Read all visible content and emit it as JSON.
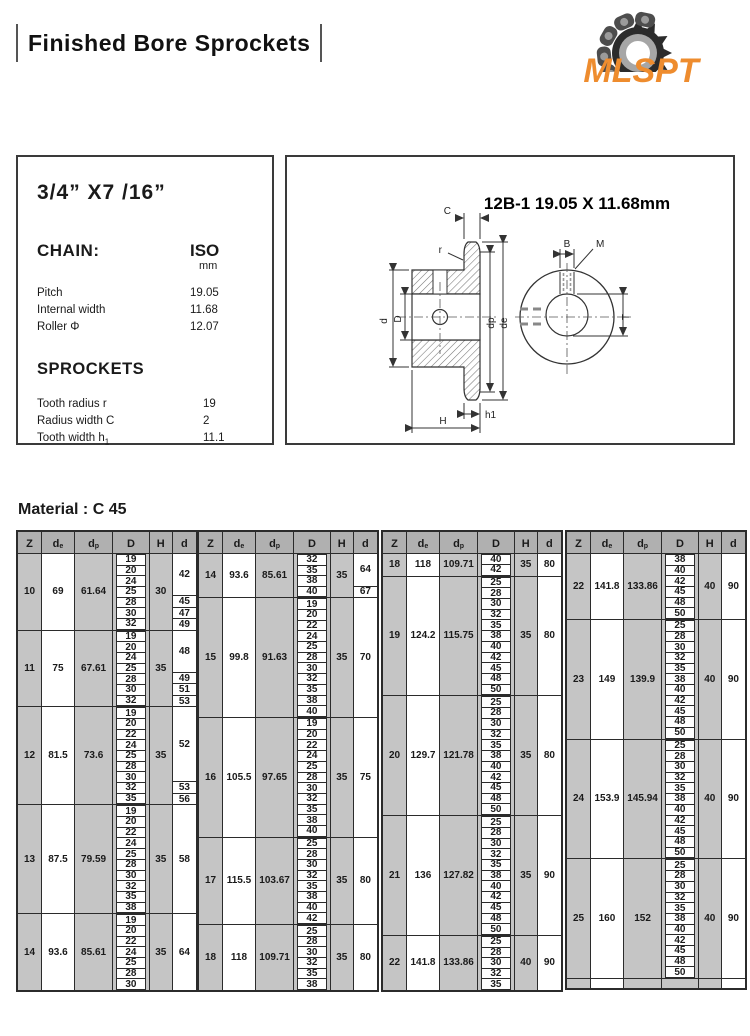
{
  "header": {
    "title": "Finished Bore Sprockets",
    "logo_text": "MLSPT",
    "logo_color": "#ee8c2e"
  },
  "spec_box": {
    "size_title": "3/4” X7 /16”",
    "chain_label": "CHAIN:",
    "standard_label": "ISO",
    "standard_unit": "mm",
    "chain_rows": [
      {
        "label": "Pitch",
        "value": "19.05"
      },
      {
        "label": "Internal width",
        "value": "11.68"
      },
      {
        "label": "Roller  Φ",
        "value": "12.07"
      }
    ],
    "sprockets_label": "SPROCKETS",
    "sprocket_rows": [
      {
        "label": "Tooth radius  r",
        "value": "19"
      },
      {
        "label": "Radius width C",
        "value": "2"
      },
      {
        "label": "Tooth width h",
        "label_sub": "1",
        "value": "11.1"
      }
    ]
  },
  "drawing": {
    "title": "12B-1 19.05 X 11.68mm",
    "labels": {
      "c": "C",
      "r": "r",
      "d_small": "d",
      "d_cap": "D",
      "dp": "dp",
      "de": "de",
      "h1": "h1",
      "h_cap": "H",
      "b": "B",
      "m": "M",
      "t": "T"
    }
  },
  "material_label": "Material : C 45",
  "table": {
    "columns": [
      {
        "label": "Z"
      },
      {
        "label": "d",
        "sub": "e"
      },
      {
        "label": "d",
        "sub": "p"
      },
      {
        "label": "D"
      },
      {
        "label": "H"
      },
      {
        "label": "d"
      }
    ]
  },
  "tables": [
    {
      "groups": [
        {
          "z": "10",
          "de": "69",
          "dp": "61.64",
          "h": "30",
          "bores": [
            "19",
            "20",
            "24",
            "25",
            "28",
            "30",
            "32"
          ],
          "d_segments": [
            {
              "value": "42",
              "span": 4
            },
            {
              "value": "45",
              "span": 1
            },
            {
              "value": "47",
              "span": 1
            },
            {
              "value": "49",
              "span": 1
            }
          ]
        },
        {
          "z": "11",
          "de": "75",
          "dp": "67.61",
          "h": "35",
          "bores": [
            "19",
            "20",
            "24",
            "25",
            "28",
            "30",
            "32"
          ],
          "d_segments": [
            {
              "value": "48",
              "span": 4
            },
            {
              "value": "49",
              "span": 1
            },
            {
              "value": "51",
              "span": 1
            },
            {
              "value": "53",
              "span": 1
            }
          ]
        },
        {
          "z": "12",
          "de": "81.5",
          "dp": "73.6",
          "h": "35",
          "bores": [
            "19",
            "20",
            "22",
            "24",
            "25",
            "28",
            "30",
            "32",
            "35"
          ],
          "d_segments": [
            {
              "value": "52",
              "span": 7
            },
            {
              "value": "53",
              "span": 1
            },
            {
              "value": "56",
              "span": 1
            }
          ]
        },
        {
          "z": "13",
          "de": "87.5",
          "dp": "79.59",
          "h": "35",
          "bores": [
            "19",
            "20",
            "22",
            "24",
            "25",
            "28",
            "30",
            "32",
            "35",
            "38"
          ],
          "d_segments": [
            {
              "value": "58",
              "span": 10
            }
          ]
        },
        {
          "z": "14",
          "de": "93.6",
          "dp": "85.61",
          "h": "35",
          "bores": [
            "19",
            "20",
            "22",
            "24",
            "25",
            "28",
            "30"
          ],
          "d_segments": [
            {
              "value": "64",
              "span": 7
            }
          ]
        }
      ]
    },
    {
      "groups": [
        {
          "z": "14",
          "de": "93.6",
          "dp": "85.61",
          "h": "35",
          "bores": [
            "32",
            "35",
            "38",
            "40"
          ],
          "d_segments": [
            {
              "value": "64",
              "span": 3
            },
            {
              "value": "67",
              "span": 1
            }
          ]
        },
        {
          "z": "15",
          "de": "99.8",
          "dp": "91.63",
          "h": "35",
          "bores": [
            "19",
            "20",
            "22",
            "24",
            "25",
            "28",
            "30",
            "32",
            "35",
            "38",
            "40"
          ],
          "d_segments": [
            {
              "value": "70",
              "span": 11
            }
          ]
        },
        {
          "z": "16",
          "de": "105.5",
          "dp": "97.65",
          "h": "35",
          "bores": [
            "19",
            "20",
            "22",
            "24",
            "25",
            "28",
            "30",
            "32",
            "35",
            "38",
            "40"
          ],
          "d_segments": [
            {
              "value": "75",
              "span": 11
            }
          ]
        },
        {
          "z": "17",
          "de": "115.5",
          "dp": "103.67",
          "h": "35",
          "bores": [
            "25",
            "28",
            "30",
            "32",
            "35",
            "38",
            "40",
            "42"
          ],
          "d_segments": [
            {
              "value": "80",
              "span": 8
            }
          ]
        },
        {
          "z": "18",
          "de": "118",
          "dp": "109.71",
          "h": "35",
          "bores": [
            "25",
            "28",
            "30",
            "32",
            "35",
            "38"
          ],
          "d_segments": [
            {
              "value": "80",
              "span": 6
            }
          ]
        }
      ]
    },
    {
      "groups": [
        {
          "z": "18",
          "de": "118",
          "dp": "109.71",
          "h": "35",
          "bores": [
            "40",
            "42"
          ],
          "d_segments": [
            {
              "value": "80",
              "span": 2
            }
          ]
        },
        {
          "z": "19",
          "de": "124.2",
          "dp": "115.75",
          "h": "35",
          "bores": [
            "25",
            "28",
            "30",
            "32",
            "35",
            "38",
            "40",
            "42",
            "45",
            "48",
            "50"
          ],
          "d_segments": [
            {
              "value": "80",
              "span": 11
            }
          ]
        },
        {
          "z": "20",
          "de": "129.7",
          "dp": "121.78",
          "h": "35",
          "bores": [
            "25",
            "28",
            "30",
            "32",
            "35",
            "38",
            "40",
            "42",
            "45",
            "48",
            "50"
          ],
          "d_segments": [
            {
              "value": "80",
              "span": 11
            }
          ]
        },
        {
          "z": "21",
          "de": "136",
          "dp": "127.82",
          "h": "35",
          "bores": [
            "25",
            "28",
            "30",
            "32",
            "35",
            "38",
            "40",
            "42",
            "45",
            "48",
            "50"
          ],
          "d_segments": [
            {
              "value": "90",
              "span": 11
            }
          ]
        },
        {
          "z": "22",
          "de": "141.8",
          "dp": "133.86",
          "h": "40",
          "bores": [
            "25",
            "28",
            "30",
            "32",
            "35"
          ],
          "d_segments": [
            {
              "value": "90",
              "span": 5
            }
          ]
        }
      ]
    },
    {
      "empty_footer": true,
      "groups": [
        {
          "z": "22",
          "de": "141.8",
          "dp": "133.86",
          "h": "40",
          "bores": [
            "38",
            "40",
            "42",
            "45",
            "48",
            "50"
          ],
          "d_segments": [
            {
              "value": "90",
              "span": 6
            }
          ]
        },
        {
          "z": "23",
          "de": "149",
          "dp": "139.9",
          "h": "40",
          "bores": [
            "25",
            "28",
            "30",
            "32",
            "35",
            "38",
            "40",
            "42",
            "45",
            "48",
            "50"
          ],
          "d_segments": [
            {
              "value": "90",
              "span": 11
            }
          ]
        },
        {
          "z": "24",
          "de": "153.9",
          "dp": "145.94",
          "h": "40",
          "bores": [
            "25",
            "28",
            "30",
            "32",
            "35",
            "38",
            "40",
            "42",
            "45",
            "48",
            "50"
          ],
          "d_segments": [
            {
              "value": "90",
              "span": 11
            }
          ]
        },
        {
          "z": "25",
          "de": "160",
          "dp": "152",
          "h": "40",
          "bores": [
            "25",
            "28",
            "30",
            "32",
            "35",
            "38",
            "40",
            "42",
            "45",
            "48",
            "50"
          ],
          "d_segments": [
            {
              "value": "90",
              "span": 11
            }
          ]
        }
      ]
    }
  ]
}
